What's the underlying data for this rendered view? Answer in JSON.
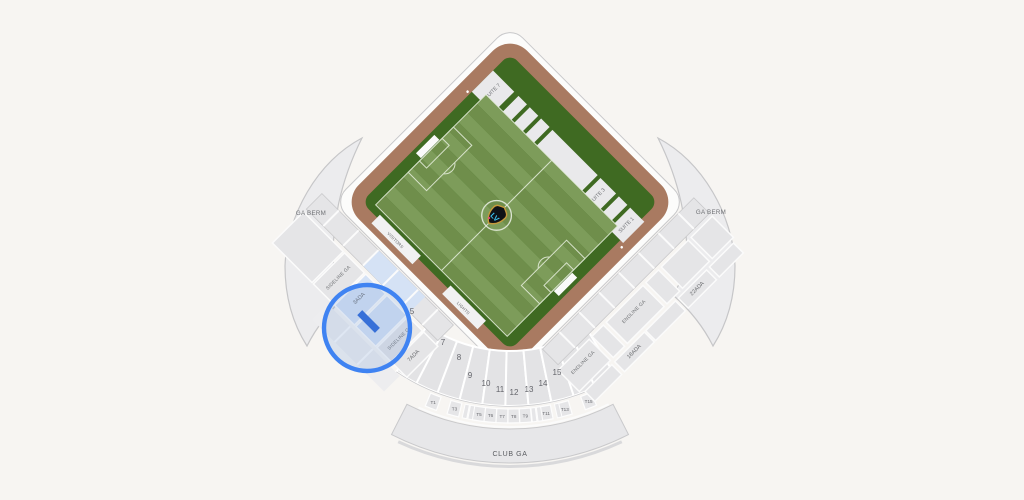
{
  "map": {
    "berm_label": "GA BERM",
    "club_label": "CLUB GA",
    "sideline_label": "SIDELINE GA",
    "endline_label": "ENDLINE GA",
    "bench_visitor": "VISITORS",
    "bench_home": "LIGHTS",
    "suites": {
      "s7": "SUITE 7",
      "s3": "SUITE 3",
      "s1": "SUITE 1"
    },
    "suite_banner": "▪▪▪▪▪▪▪▪▪▪▪▪▪ ★ ▪▪",
    "ada": {
      "a3": "3ADA",
      "a7": "7ADA",
      "a18": "18ADA",
      "a22": "22ADA"
    },
    "section_numbers": [
      "5",
      "7",
      "8",
      "9",
      "10",
      "11",
      "12",
      "13",
      "14",
      "15"
    ],
    "tables": [
      "T1",
      "T3",
      "T5",
      "T6",
      "T7",
      "T8",
      "T9",
      "T11",
      "T13",
      "T15"
    ],
    "crest_monogram": "LV",
    "colors": {
      "selection_blue": "#3f83f2",
      "selected_row_blue": "#2563d9",
      "selected_tint": "#d5e2f5",
      "field_dark": "#3f6a22",
      "stripe_a": "#7d9c5a",
      "stripe_b": "#6f8e4b",
      "track_brown": "#a97a61",
      "section_gray": "#e5e5e7",
      "background": "#f7f5f2"
    }
  }
}
